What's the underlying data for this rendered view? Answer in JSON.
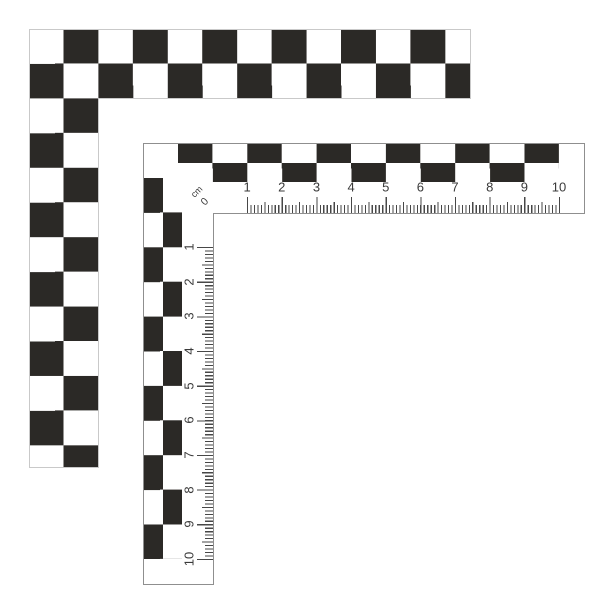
{
  "scales": {
    "unit_label": "cm",
    "zero_label": "0",
    "horizontal": {
      "numbers": [
        1,
        2,
        3,
        4,
        5,
        6,
        7,
        8,
        9,
        10
      ]
    },
    "vertical": {
      "numbers": [
        1,
        2,
        3,
        4,
        5,
        6,
        7,
        8,
        9,
        10
      ]
    }
  },
  "colors": {
    "checker_black": "#2b2926",
    "ruler_border": "#8f8f8f",
    "outer_outline": "#c9c9c9",
    "tick": "#474747",
    "label": "#3a3a3a"
  }
}
